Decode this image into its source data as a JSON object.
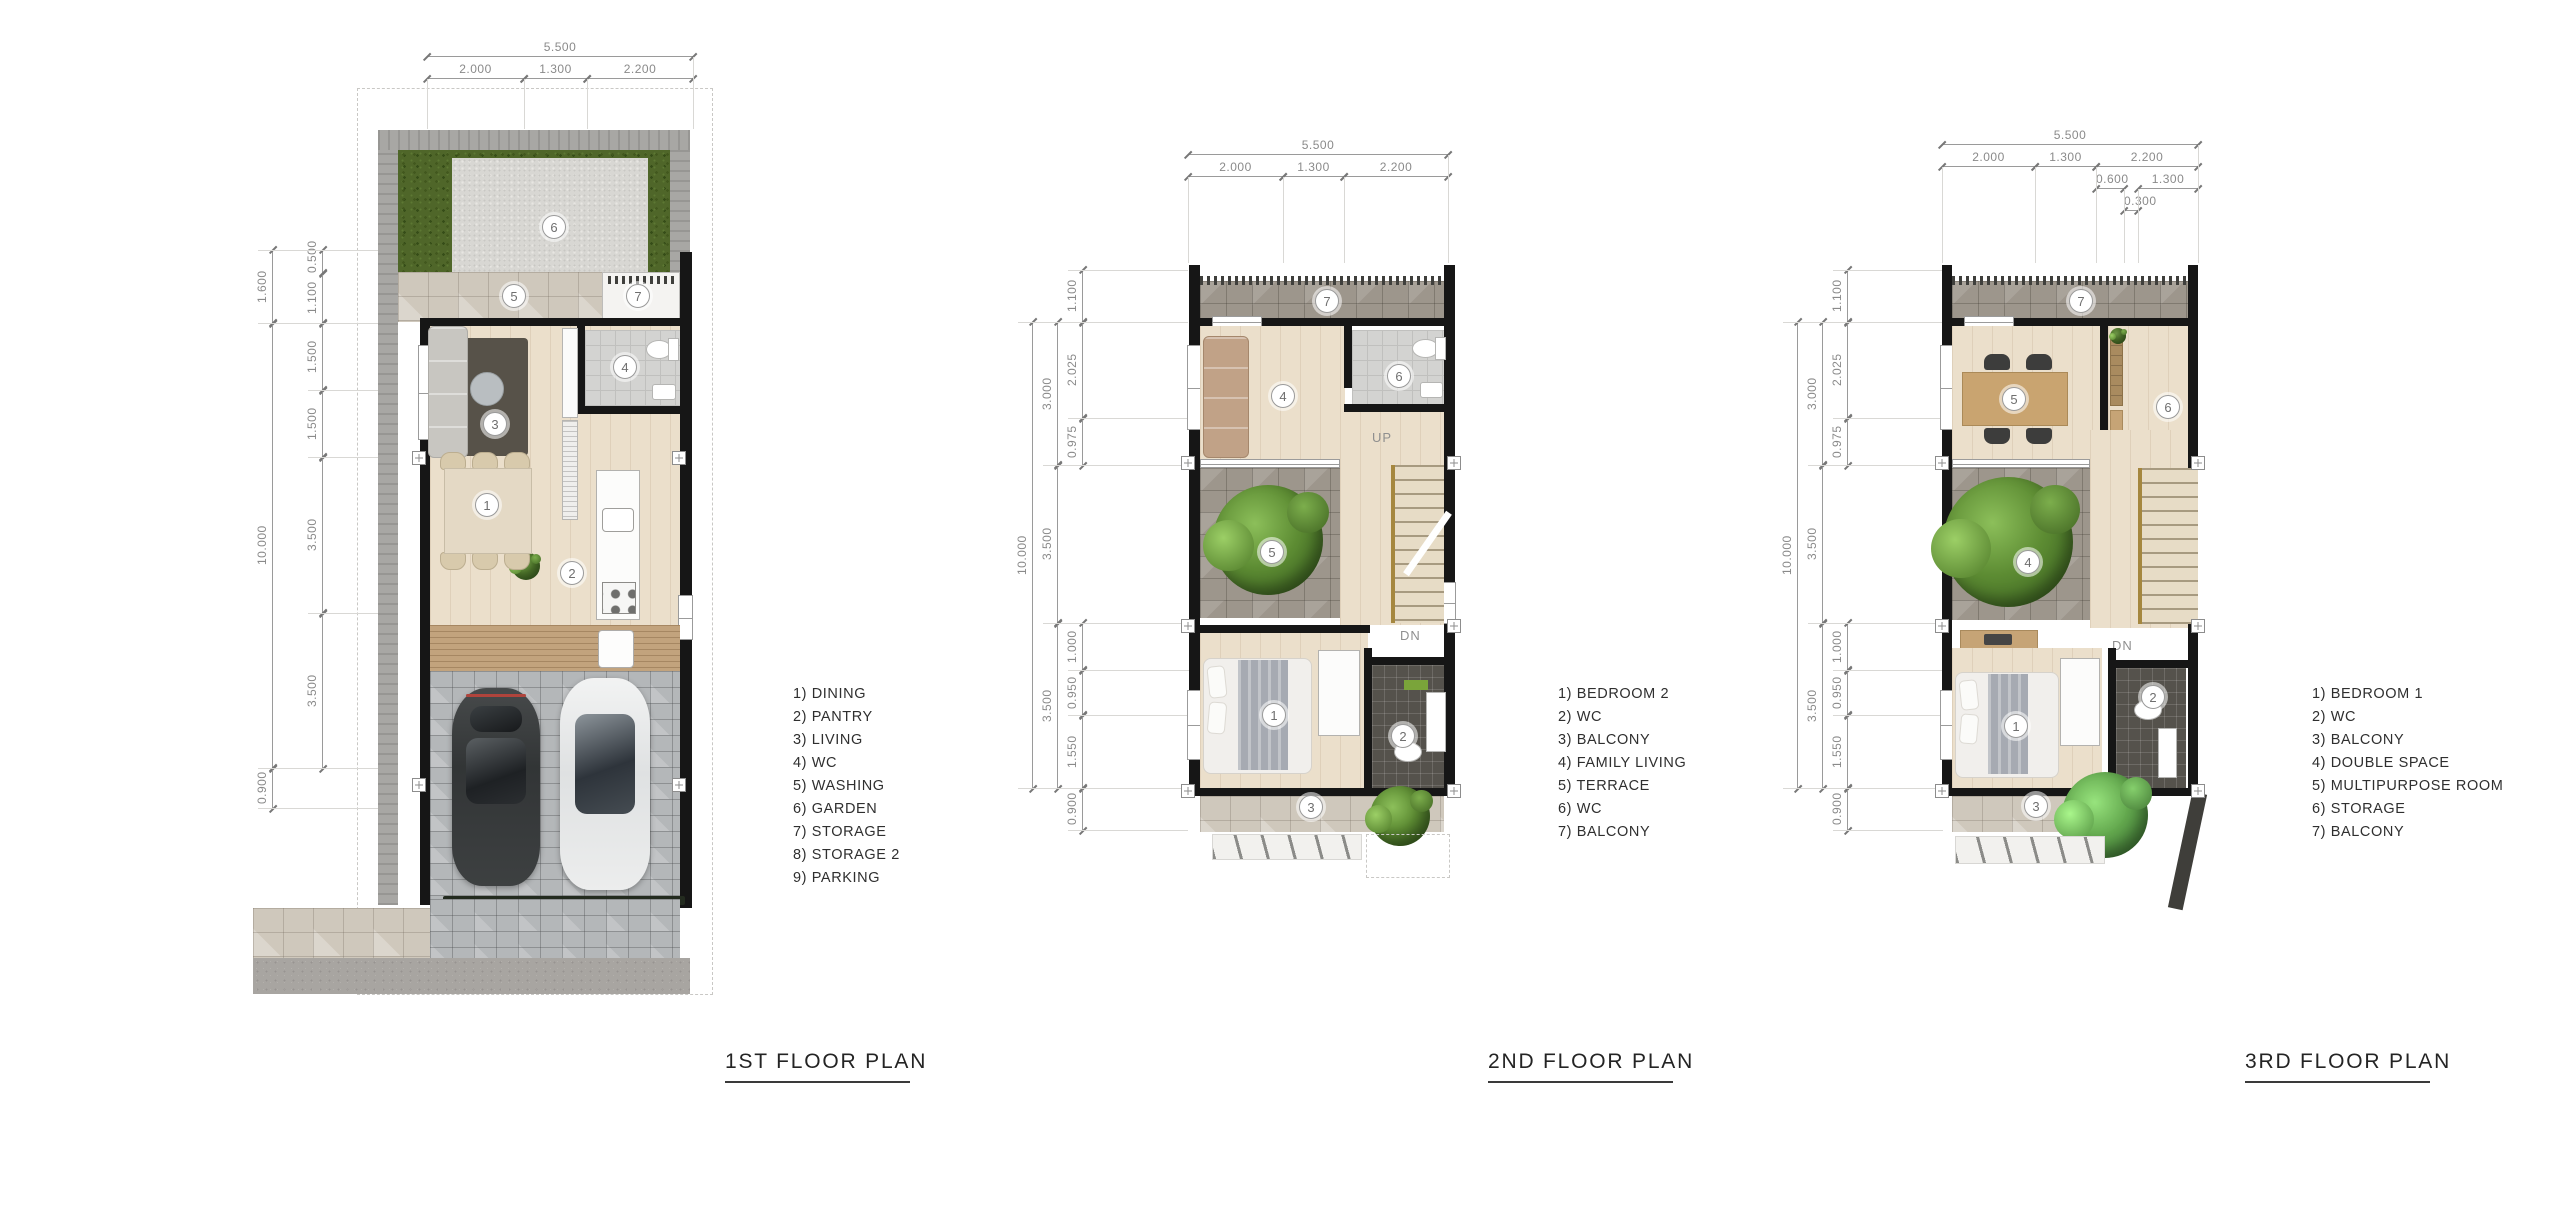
{
  "canvas": {
    "width": 2560,
    "height": 1207
  },
  "plans": [
    {
      "title": "1ST FLOOR PLAN",
      "dims": {
        "top_total": "5.500",
        "top_segments": [
          "2.000",
          "1.300",
          "2.200"
        ],
        "left_outer": [
          "1.600",
          "10.000",
          "0.900"
        ],
        "left_inner": [
          "0.500",
          "1.100",
          "1.500",
          "1.500",
          "3.500",
          "3.500"
        ]
      },
      "badges": {
        "garden": "6",
        "washing": "5",
        "storage": "7",
        "living": "3",
        "wc": "4",
        "dining": "1",
        "pantry": "2"
      },
      "legend": [
        "1) DINING",
        "2) PANTRY",
        "3) LIVING",
        "4) WC",
        "5) WASHING",
        "6) GARDEN",
        "7) STORAGE",
        "8) STORAGE 2",
        "9) PARKING"
      ]
    },
    {
      "title": "2ND FLOOR PLAN",
      "dims": {
        "top_total": "5.500",
        "top_segments": [
          "2.000",
          "1.300",
          "2.200"
        ],
        "left_outer": [
          "10.000"
        ],
        "left_mid": [
          "3.000",
          "3.500",
          "3.500"
        ],
        "left_inner": [
          "1.100",
          "2.025",
          "0.975",
          "1.000",
          "0.950",
          "1.550",
          "0.900"
        ]
      },
      "stair_labels": {
        "up": "UP",
        "dn": "DN"
      },
      "badges": {
        "balcony_top": "7",
        "family_living": "4",
        "wc_top": "6",
        "terrace": "5",
        "bedroom": "1",
        "wc_bottom": "2",
        "balcony_bottom": "3"
      },
      "legend": [
        "1) BEDROOM 2",
        "2) WC",
        "3) BALCONY",
        "4) FAMILY LIVING",
        "5) TERRACE",
        "6) WC",
        "7) BALCONY"
      ]
    },
    {
      "title": "3RD FLOOR PLAN",
      "dims": {
        "top_total": "5.500",
        "top_segments": [
          "2.000",
          "1.300",
          "2.200"
        ],
        "top_sub": [
          "0.600",
          "1.300"
        ],
        "top_sub2": [
          "0.300"
        ],
        "left_outer": [
          "10.000"
        ],
        "left_mid": [
          "3.000",
          "3.500",
          "3.500"
        ],
        "left_inner": [
          "1.100",
          "2.025",
          "0.975",
          "1.000",
          "0.950",
          "1.550",
          "0.900"
        ]
      },
      "stair_labels": {
        "dn": "DN"
      },
      "badges": {
        "balcony_top": "7",
        "multipurpose": "5",
        "storage": "6",
        "double_space": "4",
        "bedroom": "1",
        "wc": "2",
        "balcony_bottom": "3"
      },
      "legend": [
        "1) BEDROOM 1",
        "2) WC",
        "3) BALCONY",
        "4) DOUBLE SPACE",
        "5) MULTIPURPOSE ROOM",
        "6) STORAGE",
        "7) BALCONY"
      ]
    }
  ]
}
